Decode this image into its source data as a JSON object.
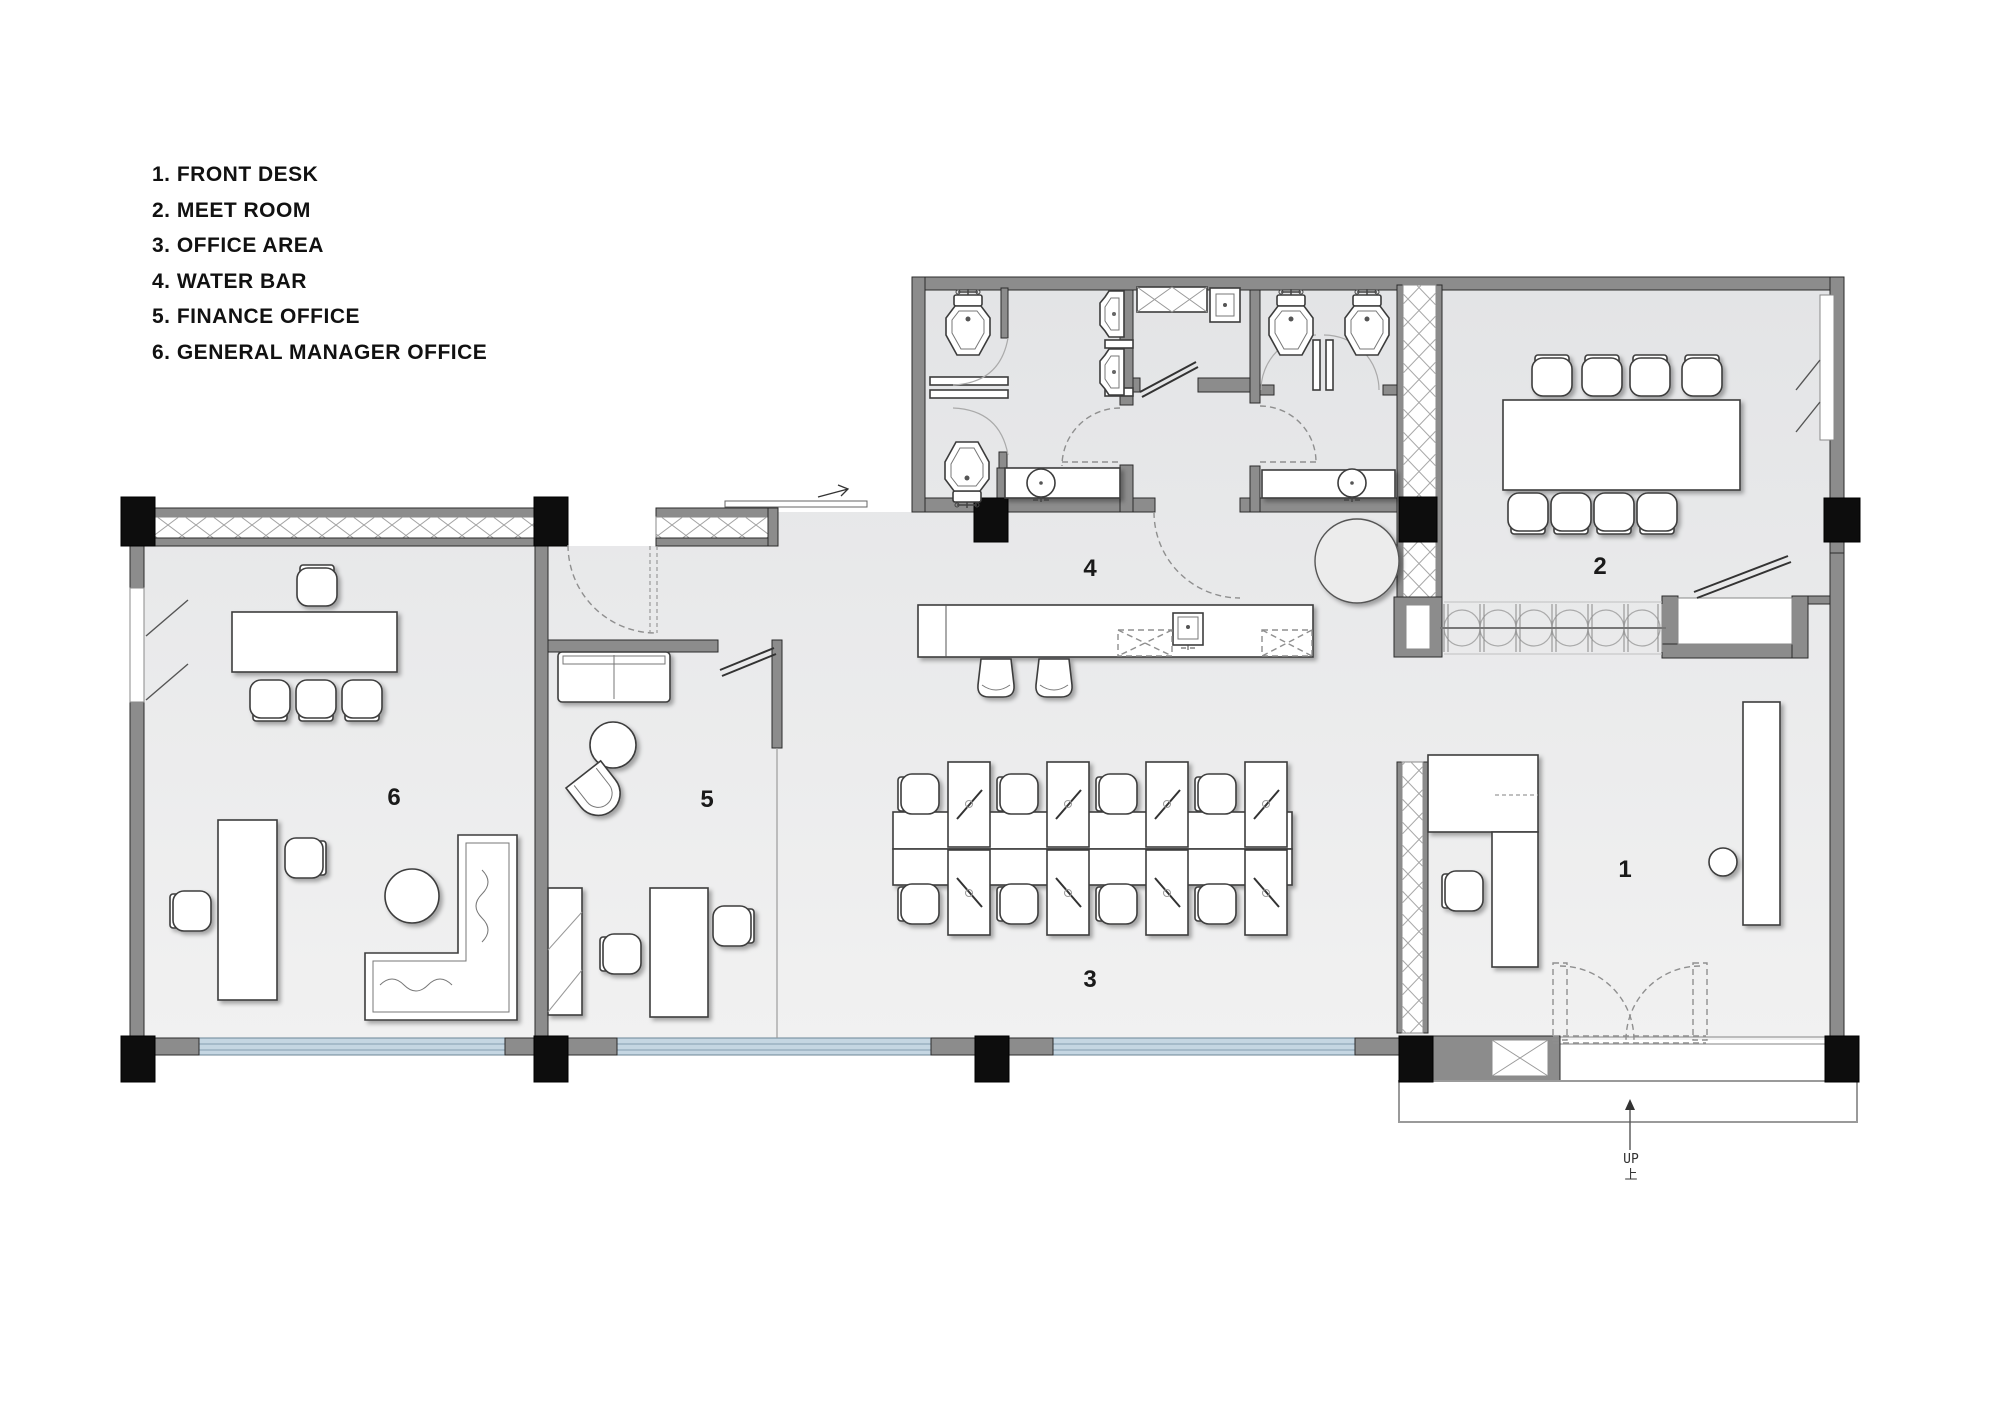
{
  "legend": {
    "items": [
      "1. FRONT DESK",
      "2. MEET ROOM",
      "3. OFFICE AREA",
      "4. WATER BAR",
      "5. FINANCE OFFICE",
      "6. GENERAL MANAGER OFFICE"
    ]
  },
  "rooms": [
    {
      "number": "1",
      "name": "FRONT DESK"
    },
    {
      "number": "2",
      "name": "MEET ROOM"
    },
    {
      "number": "3",
      "name": "OFFICE AREA"
    },
    {
      "number": "4",
      "name": "WATER BAR"
    },
    {
      "number": "5",
      "name": "FINANCE OFFICE"
    },
    {
      "number": "6",
      "name": "GENERAL MANAGER OFFICE"
    }
  ],
  "stair": {
    "up_label": "UP",
    "up_label_cn": "上"
  },
  "colors": {
    "wall": "#8c8c8c",
    "column": "#0d0d0d",
    "floor": "#e8e9ea",
    "glazing": "#c5d6e2",
    "furniture": "#ffffff"
  }
}
